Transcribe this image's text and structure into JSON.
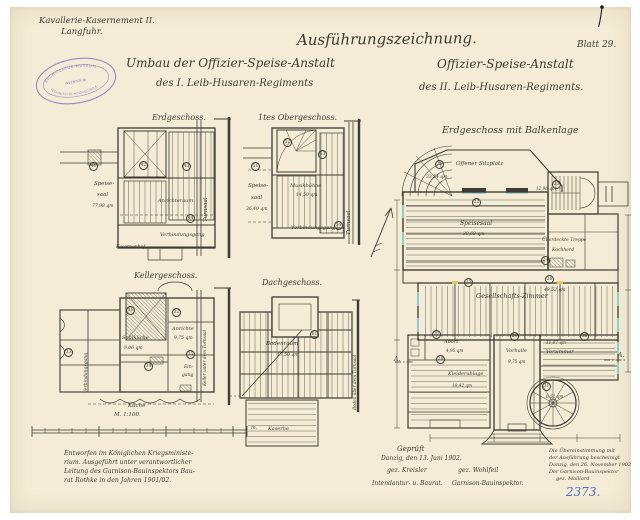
{
  "colors": {
    "ink": "#3d3b33",
    "paper": "#f4ecd6",
    "stamp_purple": "#8a79b8",
    "note_blue": "#4a6fc4",
    "window_cyan": "#8fcec6",
    "accent_yellow": "#dfca67"
  },
  "header": {
    "site1": "Kavallerie-Kasernement II.",
    "site2": "Langfuhr.",
    "drawing_type": "Ausführungszeichnung.",
    "sheet": "Blatt 29.",
    "umbau1": "Umbau der Offizier-Speise-Anstalt",
    "umbau2": "des I. Leib-Husaren-Regiments",
    "neu1": "Offizier-Speise-Anstalt",
    "neu2": "des II. Leib-Husaren-Regiments."
  },
  "stamp": {
    "top": "ARCHITEKTUR-MUSEUM",
    "mid": "INVENTAR-Nr.",
    "bottom": "TECHNISCHE HOCHSCHULE"
  },
  "erdI": {
    "title": "Erdgeschoss.",
    "speise1": "Speise-",
    "speise2": "saal",
    "speise_area": "77,98 qm",
    "anricht": "Anrichteraum",
    "verbind": "Verbindungsgang",
    "turnsaal": "Turnsaal",
    "hof": "Kasernenhof",
    "c1": "41",
    "c2": "42",
    "c3": "43",
    "c4": "44"
  },
  "obergI": {
    "title": "1tes Obergeschoss.",
    "speise1": "Speise-",
    "speise2": "saal",
    "speise_area": "36,40 qm",
    "musik": "Musikbühne",
    "musik_area": "14,50 qm",
    "verbind": "Verbindungsgang",
    "turnsaal": "Turnsaal",
    "c1": "51",
    "c2": "52",
    "c3": "53",
    "c4": "54"
  },
  "kellerI": {
    "title": "Kellergeschoss.",
    "spuel": "Spülküche",
    "spuel_area": "9,06 qm",
    "anrichte": "Anrichte",
    "anrichte_area": "9,75 qm",
    "eingang1": "Ein-",
    "eingang2": "gang",
    "kueche": "Küche",
    "gang": "Verbindungsgang",
    "keller_halle": "Keller unter dem Turnsaal",
    "c1": "31",
    "c2": "32",
    "c3": "33",
    "c4": "34",
    "c5": "35"
  },
  "dachI": {
    "title": "Dachgeschoss.",
    "boden": "Bodenraum",
    "boden_area": "17,50 qm",
    "kaserne": "Kaserne",
    "halle": "Boden über dem Turnsaal",
    "c1": "61"
  },
  "erdII": {
    "title": "Erdgeschoss mit Balkenlage",
    "sitzplatz": "Offener Sitzplatz",
    "sitzplatz_area": "33,54 qm",
    "speisesaal": "Speisesaal",
    "speisesaal_area": "39,68 qm",
    "treppe_area": "12,96 qm",
    "ueberdeckt": "Überdeckte Treppe",
    "kochherd": "Kochherd",
    "gesellschaft": "Gesellschafts-Zimmer",
    "gesellschaft_area": "49,52 qm",
    "abort": "Abort",
    "abort_area": "4,95 qm",
    "kleider": "Kleiderablage",
    "kleider_area": "10,92 qm",
    "vorhalle": "Vorhalle",
    "vorhalle_area": "9,75 qm",
    "vorzimmer": "Vorzimmer",
    "vorzimmer_area": "11,07 qm",
    "wendel_area": "6,52 qm",
    "secL": "A.",
    "secR": "A.",
    "c1": "21",
    "c2": "22",
    "c3": "23",
    "c4": "24",
    "c5": "25",
    "c6": "26",
    "c7": "27",
    "c8": "28",
    "c9": "29",
    "c10": "30",
    "c11": "31"
  },
  "scale": {
    "label": "M. 1:100.",
    "unit": "m."
  },
  "notes": {
    "d1": "Entworfen im Königlichen Kriegsministe-",
    "d2": "rium. Ausgeführt unter verantwortlicher",
    "d3": "Leitung des Garnison-Bauinspektors Bau-",
    "d4": "rat Rothke in den Jahren 1901/02.",
    "geprueft": "Geprüft",
    "ort": "Danzig, den 13. Juni 1902.",
    "sig1": "gez. Kreisler",
    "role1": "Intendantur- u. Baurat.",
    "sig2": "gez. Wohlfeil",
    "role2": "Garnison-Bauinspektor.",
    "best1": "Die Übereinstimmung mit",
    "best2": "der Ausführung bescheinigt",
    "best3": "Danzig, den 26. November 1902",
    "best4": "Der Garnison-Bauinspektor",
    "best5": "gez. Maillard",
    "nummer": "2373."
  }
}
